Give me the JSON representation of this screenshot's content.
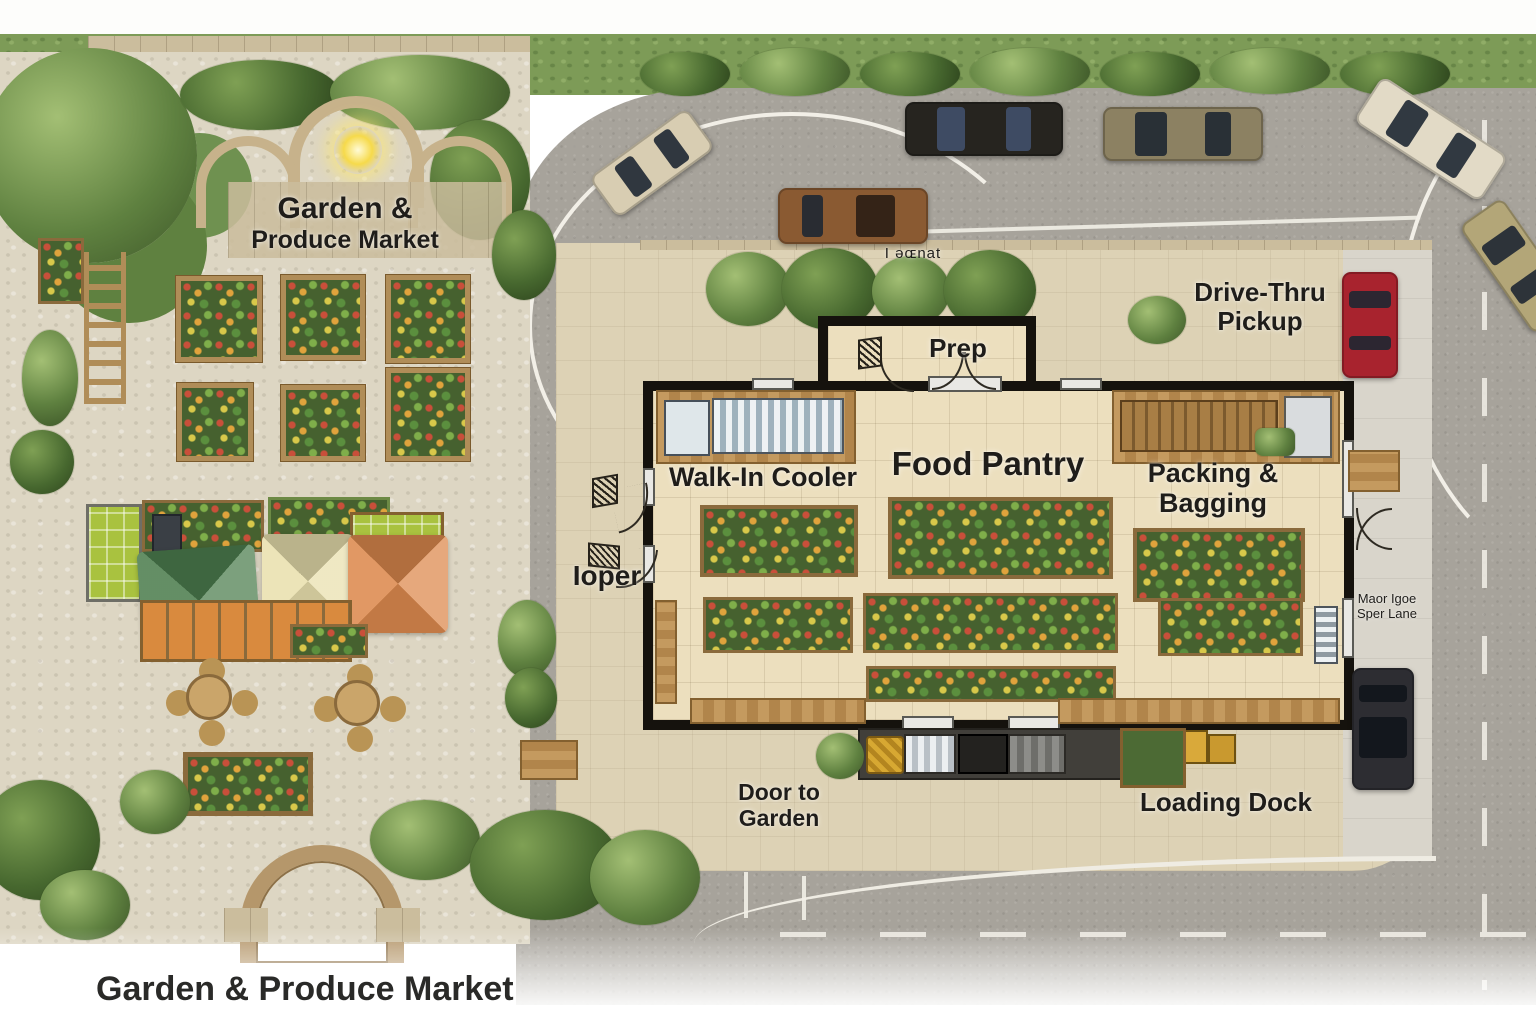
{
  "scene": {
    "garden_sign": {
      "line1": "Garden &",
      "line2": "Produce Market"
    },
    "bottom_title": "Garden & Produce Market",
    "parking": {
      "drive_thru_line1": "Drive-Thru",
      "drive_thru_line2": "Pickup",
      "stray_text": "I əɶnat"
    },
    "building": {
      "prep": "Prep",
      "walk_in_cooler": "Walk-In Cooler",
      "food_pantry": "Food Pantry",
      "packing_line1": "Packing &",
      "packing_line2": "Bagging",
      "entry_text": "Ioper",
      "door_to_garden_line1": "Door to",
      "door_to_garden_line2": "Garden",
      "loading_dock": "Loading Dock"
    },
    "drive_lane": {
      "line1": "Maor Igoe",
      "line2": "Sper Lane"
    },
    "vehicles": [
      {
        "name": "beige-sedan",
        "color": "#d8cdb2"
      },
      {
        "name": "black-sedan",
        "color": "#26241f"
      },
      {
        "name": "olive-sedan",
        "color": "#8c8162"
      },
      {
        "name": "brown-suv",
        "color": "#8a5a32"
      },
      {
        "name": "cream-sedan",
        "color": "#e2dac6"
      },
      {
        "name": "tan-car",
        "color": "#b3a678"
      },
      {
        "name": "red-car",
        "color": "#a8232e"
      },
      {
        "name": "dark-suv",
        "color": "#2d2d32"
      }
    ],
    "tents": [
      {
        "name": "green-tent",
        "color": "#4e7f50"
      },
      {
        "name": "cream-tent",
        "color": "#e9e0ae"
      },
      {
        "name": "orange-tent",
        "color": "#dd8a4e"
      }
    ],
    "colors": {
      "grass": "#7d9b57",
      "asphalt": "#a7a39b",
      "plaza": "#ddd2b5",
      "building_floor": "#ecdfbe",
      "wall": "#15120d",
      "stone_patio": "#ddd6c3",
      "wood": "#b08d58"
    }
  }
}
